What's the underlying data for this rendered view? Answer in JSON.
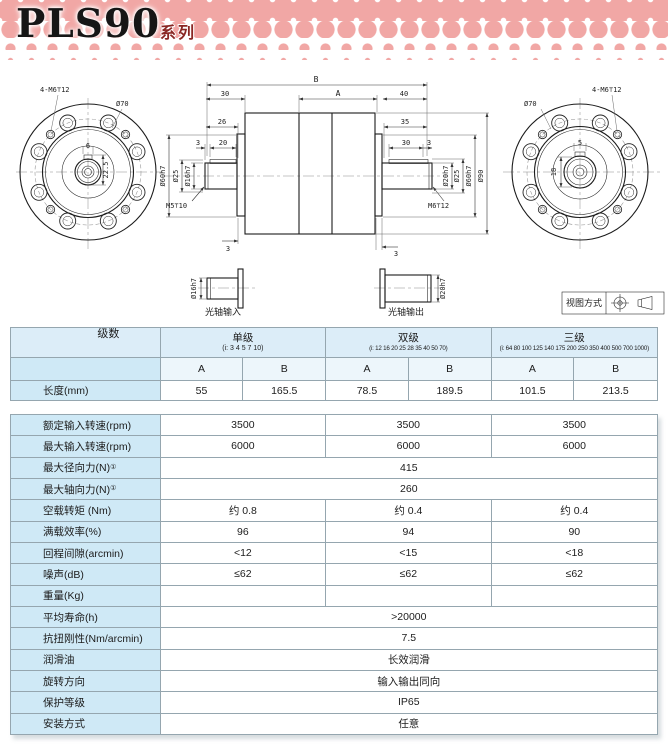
{
  "page": {
    "title": "PLS90",
    "series_badge": "系列"
  },
  "colors": {
    "pink": "#f1a7a5",
    "badge_text": "#8a2724",
    "label_bg": "#cfe9f6",
    "header_bg": "#dcedf8",
    "border": "#95a6af"
  },
  "drawing": {
    "left_flange": {
      "tap": "4-M6⊤12",
      "bolt_circle_dia": "Ø70",
      "key_width": "6",
      "key_depth": "22.5"
    },
    "right_flange": {
      "tap": "4-M6⊤12",
      "bolt_circle_dia": "Ø70",
      "key_width": "5",
      "key_depth": "18"
    },
    "side_view": {
      "dim_b": "B",
      "dim_a": "A",
      "dim_30_left": "30",
      "dim_40": "40",
      "dim_26": "26",
      "dim_35": "35",
      "dim_3a": "3",
      "dim_20": "20",
      "dim_30_right": "30",
      "dim_3b": "3",
      "dim_3_bottom_left": "3",
      "dim_3_bottom_right": "3",
      "dia_60h7_left": "Ø60h7",
      "dia_25_left": "Ø25",
      "dia_16h7": "Ø16h7",
      "tap_input": "M5⊤10",
      "tap_output": "M6⊤12",
      "dia_20h7": "Ø20h7",
      "dia_25_right": "Ø25",
      "dia_60h7_right": "Ø60h7",
      "dia_90": "Ø90"
    },
    "input_detail": {
      "dia": "Ø16h7",
      "caption": "光轴输入"
    },
    "output_detail": {
      "dia": "Ø20h7",
      "caption": "光轴输出"
    },
    "view_method": {
      "label": "视图方式"
    }
  },
  "table": {
    "header": {
      "stage_label": "级数",
      "groups": [
        {
          "name": "单级",
          "ratios": "(i: 3 4 5 7 10)"
        },
        {
          "name": "双级",
          "ratios": "(i: 12 16 20 25 28 35 40 50 70)"
        },
        {
          "name": "三级",
          "ratios": "(i: 64 80 100 125 140 175 200 250 350 400 500 700 1000)"
        }
      ],
      "sub_cols": [
        "A",
        "B",
        "A",
        "B",
        "A",
        "B"
      ]
    },
    "length_row": {
      "label": "长度(mm)",
      "values": [
        "55",
        "165.5",
        "78.5",
        "189.5",
        "101.5",
        "213.5"
      ]
    },
    "spec_rows": [
      {
        "label": "额定输入转速(rpm)",
        "span": "group",
        "values": [
          "3500",
          "3500",
          "3500"
        ]
      },
      {
        "label": "最大输入转速(rpm)",
        "span": "group",
        "values": [
          "6000",
          "6000",
          "6000"
        ]
      },
      {
        "label": "最大径向力(N)①",
        "span": "full",
        "values": [
          "415"
        ]
      },
      {
        "label": "最大轴向力(N)①",
        "span": "full",
        "values": [
          "260"
        ]
      },
      {
        "label": "空载转矩 (Nm)",
        "span": "group",
        "values": [
          "约 0.8",
          "约 0.4",
          "约 0.4"
        ]
      },
      {
        "label": "满载效率(%)",
        "span": "group",
        "values": [
          "96",
          "94",
          "90"
        ]
      },
      {
        "label": "回程间隙(arcmin)",
        "span": "group",
        "values": [
          "<12",
          "<15",
          "<18"
        ]
      },
      {
        "label": "噪声(dB)",
        "span": "group",
        "values": [
          "≤62",
          "≤62",
          "≤62"
        ]
      },
      {
        "label": "重量(Kg)",
        "span": "group",
        "values": [
          "",
          "",
          ""
        ]
      },
      {
        "label": "平均寿命(h)",
        "span": "full",
        "values": [
          ">20000"
        ]
      },
      {
        "label": "抗扭刚性(Nm/arcmin)",
        "span": "full",
        "values": [
          "7.5"
        ]
      },
      {
        "label": "润滑油",
        "span": "full",
        "values": [
          "长效润滑"
        ]
      },
      {
        "label": "旋转方向",
        "span": "full",
        "values": [
          "输入输出同向"
        ]
      },
      {
        "label": "保护等级",
        "span": "full",
        "values": [
          "IP65"
        ]
      },
      {
        "label": "安装方式",
        "span": "full",
        "values": [
          "任意"
        ]
      }
    ]
  }
}
